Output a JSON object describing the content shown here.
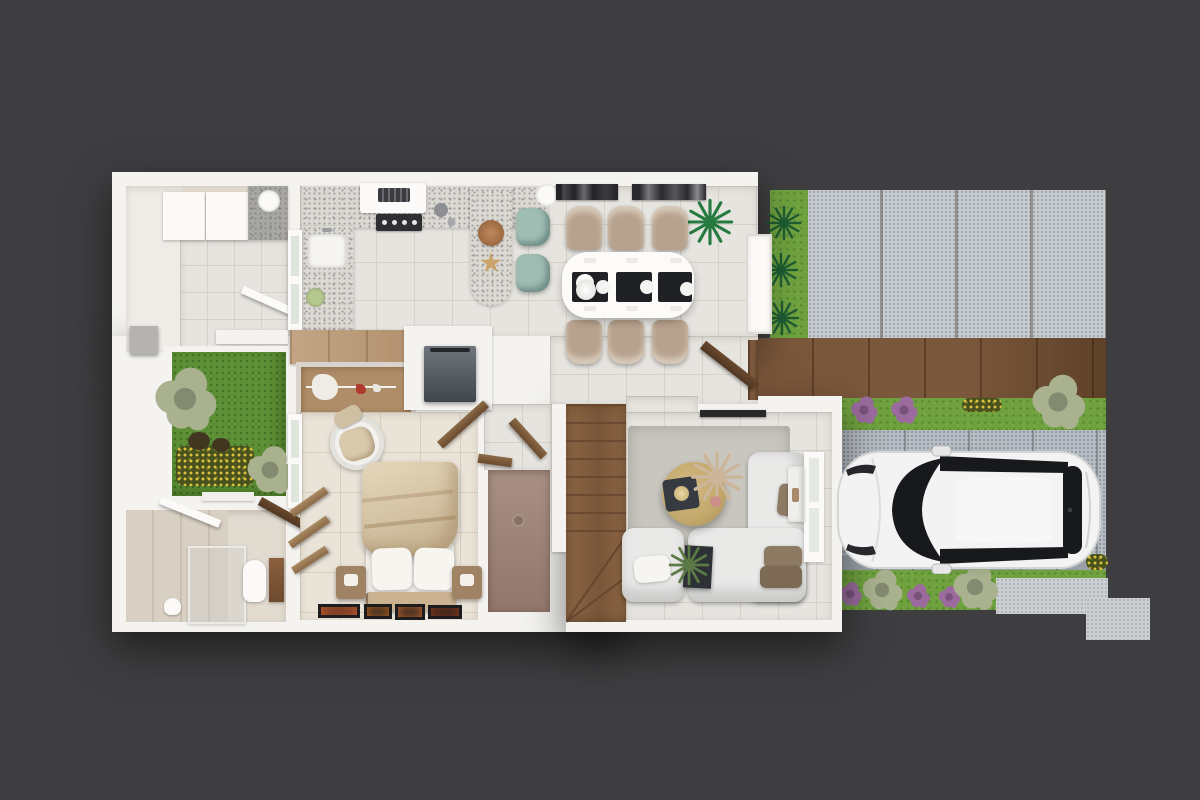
{
  "scene": {
    "kind": "3d-floor-plan-render",
    "view": "top-down",
    "floor": "ground floor with driveway and garden"
  },
  "colors": {
    "bg": "#3e3e40",
    "wall": "#f4f3f0",
    "tile": "#e6e4df",
    "tile-warm": "#eae3d8",
    "counter": "#dcd9d3",
    "wood-cab": "#c2a585",
    "wood-closet": "#b08d69",
    "stairwood": "#8a6544",
    "stair-line": "#66462e",
    "deck": "#7b573b",
    "deck-dark": "#5e4128",
    "grass": "#6fa23f",
    "grass-dark": "#5d9036",
    "paver": "#c6cbd0",
    "paver-seam": "#94928c",
    "drive": "#b7bdc4",
    "drive-edge": "#9aa1a9",
    "concrete": "#ccd0d3",
    "mauve-floor": "#9c8173",
    "car-body": "#f2f3f2",
    "car-glass": "#17191c",
    "stool-teal": "#9fbdb3",
    "chair-beige": "#b7a28d",
    "blanket": "#d9c7a9",
    "rug": "#c9c6bf",
    "sofa": "#e9e9e8",
    "brass": "#c3a86b",
    "pillow-brown": "#8d7a63",
    "placemat": "#202124",
    "machine-top": "#70757d",
    "machine-bottom": "#41464d",
    "sage": "#a9b18f",
    "palm-green": "#1e5c33",
    "plant-green": "#5c7a46",
    "flower-purple": "#9b6b9e",
    "flower-yellow": "#d9c23f",
    "art-orange": "#c3582b",
    "art-dark": "#1d1d1f"
  },
  "rooms": [
    {
      "name": "utility-room",
      "features": [
        "white-cabinets",
        "laundry-counter",
        "sink"
      ]
    },
    {
      "name": "courtyard-garden",
      "features": [
        "lawn",
        "shrubs",
        "flower-bed"
      ]
    },
    {
      "name": "bathroom",
      "features": [
        "glass-shower",
        "toilet",
        "wood-cabinet"
      ]
    },
    {
      "name": "kitchen",
      "features": [
        "terrazzo-counter",
        "cooktop",
        "hood",
        "sink",
        "breakfast-bar",
        "two-teal-stools",
        "sideboard",
        "open-wardrobe",
        "washing-machine"
      ]
    },
    {
      "name": "dining-area",
      "features": [
        "white-table",
        "six-beige-chairs",
        "three-placemats",
        "palm-plant",
        "two-dark-wall-panels",
        "exterior-door"
      ]
    },
    {
      "name": "bedroom",
      "features": [
        "double-bed",
        "two-nightstands",
        "bench",
        "round-armchair",
        "four-art-frames-on-floor",
        "window"
      ]
    },
    {
      "name": "shower-room",
      "features": [
        "mauve-tiled-floor",
        "floor-drain"
      ]
    },
    {
      "name": "staircase",
      "features": [
        "timber-treads",
        "winder-landing"
      ]
    },
    {
      "name": "living-room",
      "features": [
        "area-rug",
        "l-shaped-white-sofa",
        "brass-coffee-table",
        "pampas-decor",
        "planter",
        "window",
        "tv-panel"
      ]
    }
  ],
  "exterior": {
    "features": [
      "stone-paver-patio",
      "timber-deck",
      "lawn-strips",
      "spiky-plants",
      "sage-bushes",
      "purple-flower-bushes",
      "yellow-flower-beds",
      "paver-driveway",
      "concrete-step",
      "utility-meter-box"
    ],
    "vehicle": {
      "type": "car",
      "body_color_name": "white",
      "facing": "left",
      "parked_on": "driveway"
    }
  }
}
